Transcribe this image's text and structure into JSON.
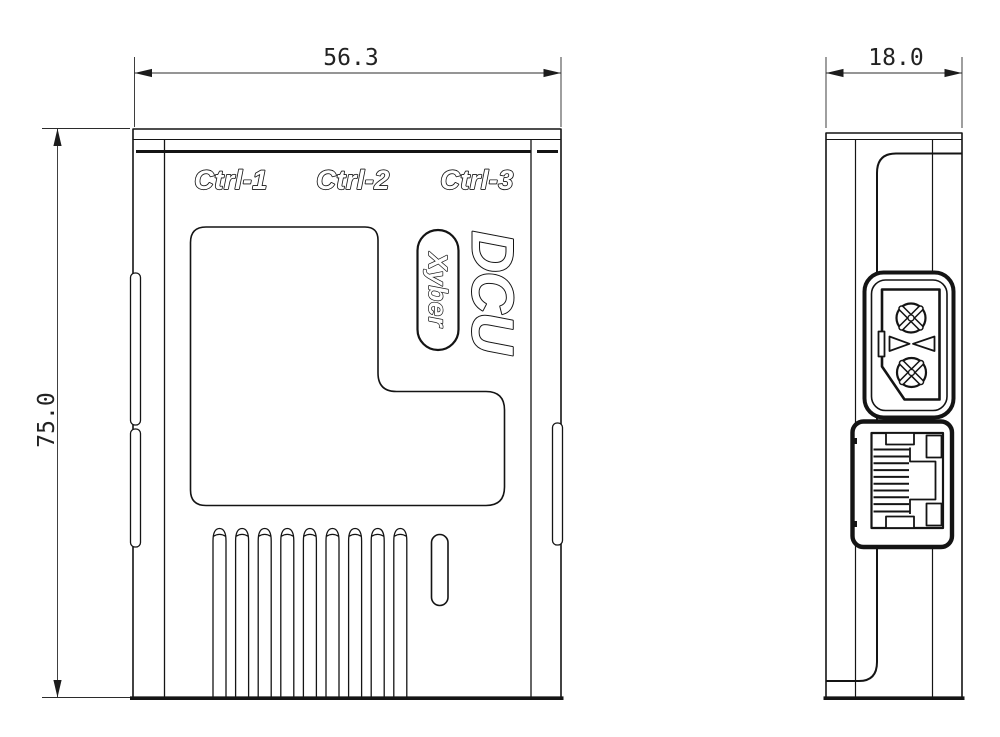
{
  "dimensions": {
    "width_mm": "56.3",
    "height_mm": "75.0",
    "depth_mm": "18.0"
  },
  "front_view": {
    "port_labels": [
      "Ctrl-1",
      "Ctrl-2",
      "Ctrl-3"
    ],
    "model_name": "DCU",
    "brand_name": "Xyber"
  },
  "colors": {
    "line": "#141414",
    "background": "#ffffff"
  }
}
